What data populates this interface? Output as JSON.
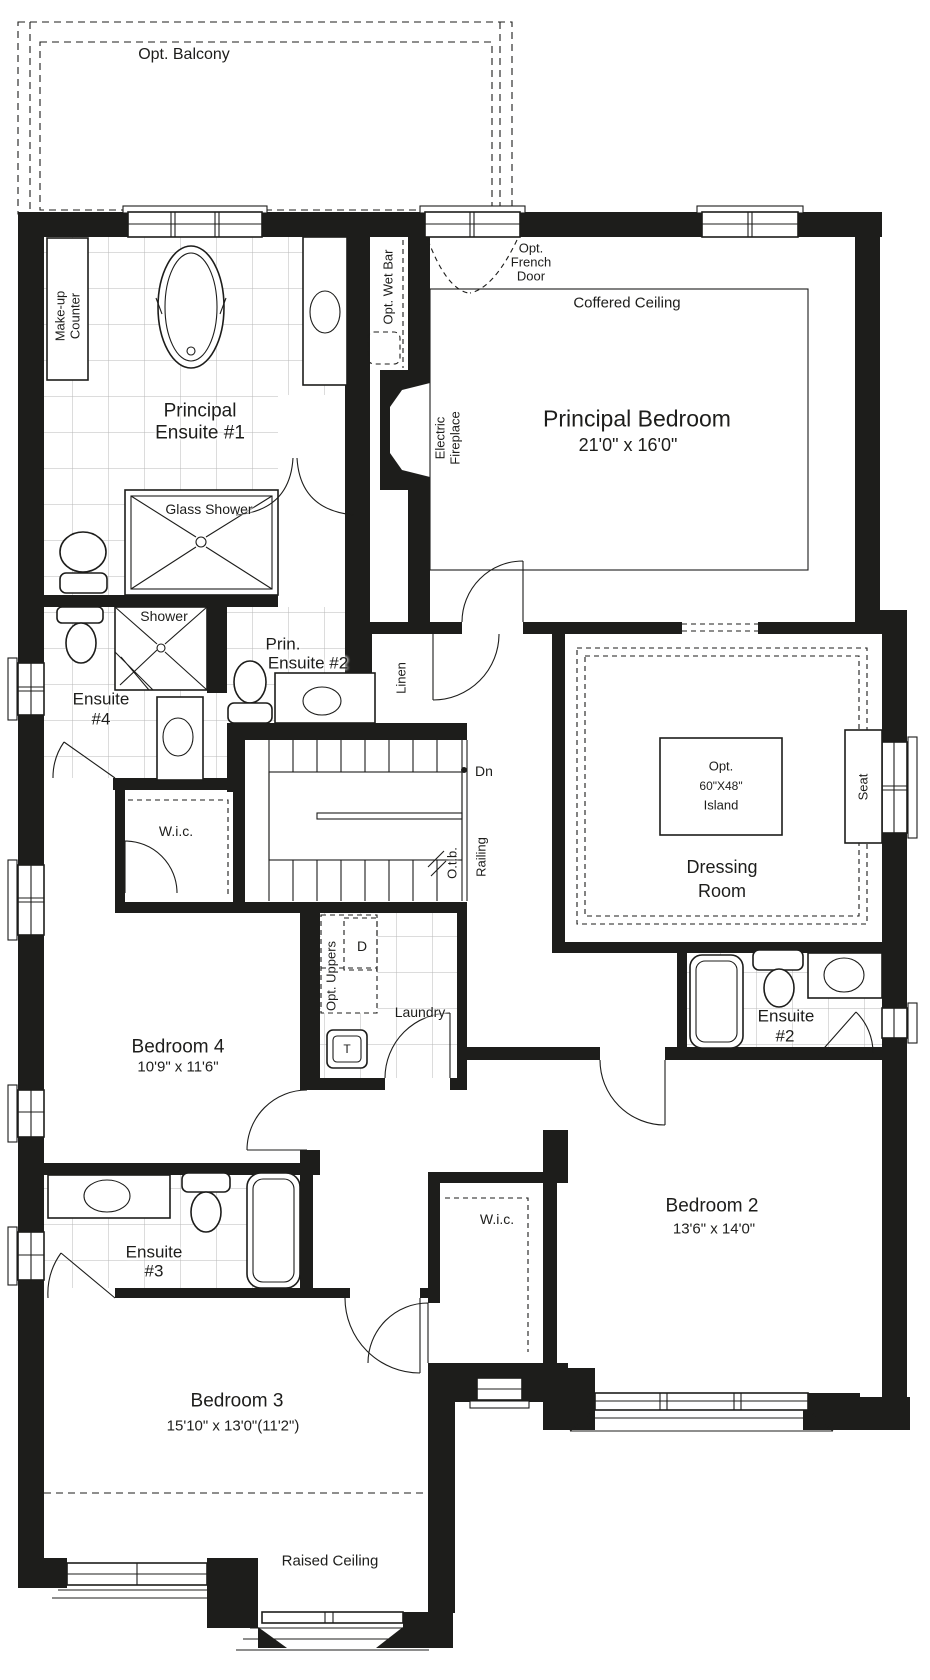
{
  "colors": {
    "wall": "#1d1d1b",
    "line": "#1d1d1b",
    "tile_grid": "#b9b9b9",
    "background": "#ffffff"
  },
  "labels": {
    "opt_balcony": "Opt. Balcony",
    "makeup_counter": [
      "Make-up",
      "Counter"
    ],
    "principal_ensuite_1": [
      "Principal",
      "Ensuite #1"
    ],
    "opt_wet_bar": "Opt. Wet Bar",
    "opt_french_door": [
      "Opt.",
      "French",
      "Door"
    ],
    "coffered_ceiling": "Coffered Ceiling",
    "principal_bedroom": {
      "name": "Principal Bedroom",
      "dims": "21'0\" x 16'0\""
    },
    "electric_fireplace": [
      "Electric",
      "Fireplace"
    ],
    "glass_shower": "Glass Shower",
    "shower": "Shower",
    "prin_ensuite_2": [
      "Prin.",
      "Ensuite #2"
    ],
    "linen": "Linen",
    "ensuite_4": [
      "Ensuite",
      "#4"
    ],
    "dn": "Dn",
    "otb": "O.t.b.",
    "railing": "Railing",
    "opt_island": [
      "Opt.",
      "60\"X48\"",
      "Island"
    ],
    "seat": "Seat",
    "dressing_room": [
      "Dressing",
      "Room"
    ],
    "wic_upper": "W.i.c.",
    "opt_uppers": "Opt. Uppers",
    "dryer": "D",
    "laundry": "Laundry",
    "bedroom_4": {
      "name": "Bedroom 4",
      "dims": "10'9\" x 11'6\""
    },
    "laundry_tub": "T",
    "ensuite_2": [
      "Ensuite",
      "#2"
    ],
    "wic_lower": "W.i.c.",
    "bedroom_2": {
      "name": "Bedroom 2",
      "dims": "13'6\" x 14'0\""
    },
    "ensuite_3": [
      "Ensuite",
      "#3"
    ],
    "bedroom_3": {
      "name": "Bedroom 3",
      "dims": "15'10\" x 13'0\"(11'2\")"
    },
    "raised_ceiling": "Raised Ceiling"
  }
}
